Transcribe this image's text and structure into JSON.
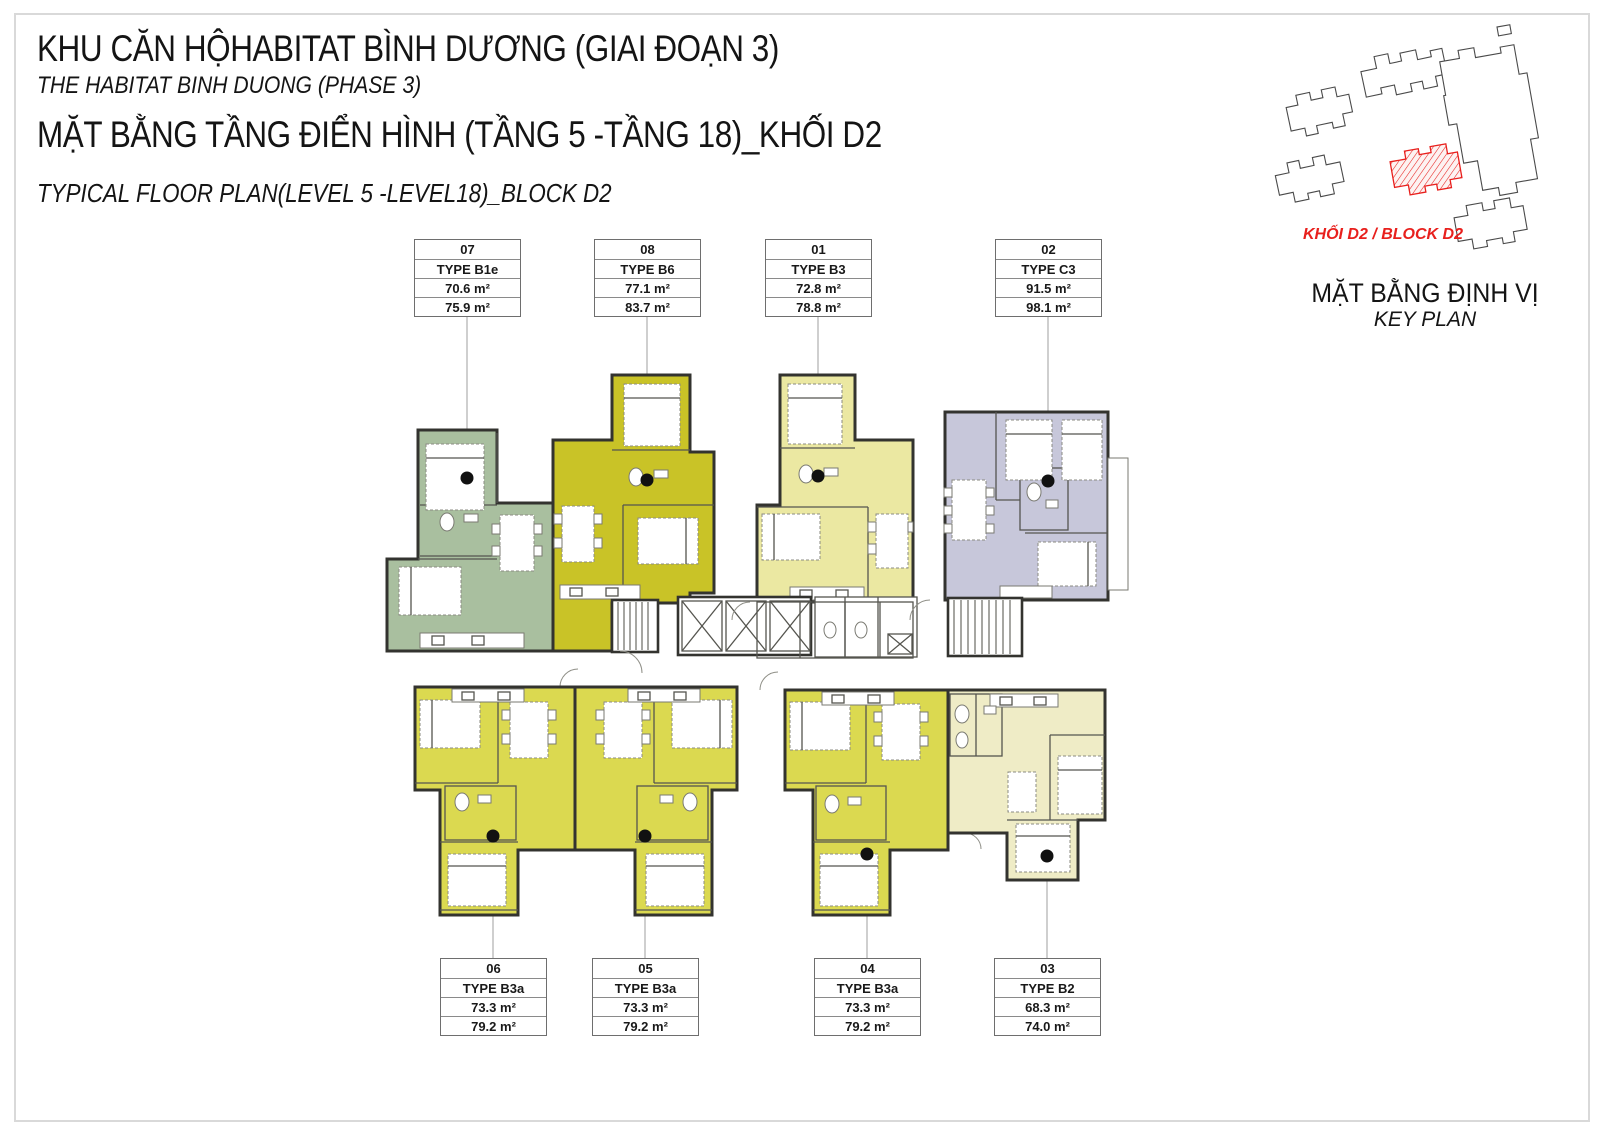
{
  "title_block": {
    "project_vi": "KHU CĂN HỘHABITAT BÌNH DƯƠNG (GIAI ĐOẠN 3)",
    "project_en": "THE HABITAT BINH DUONG (PHASE 3)",
    "plan_vi": "MẶT BẰNG TẦNG ĐIỂN HÌNH (TẦNG 5 -TẦNG 18)_KHỐI D2",
    "plan_en": "TYPICAL FLOOR PLAN(LEVEL 5 -LEVEL18)_BLOCK D2"
  },
  "key_plan": {
    "block_label": "KHỐI D2 / BLOCK D2",
    "block_label_color": "#e8201d",
    "title_vi": "MẶT BẰNG ĐỊNH VỊ",
    "title_en": "KEY PLAN"
  },
  "units": [
    {
      "number": "07",
      "type": "TYPE B1e",
      "area_net": "70.6 m²",
      "area_gross": "75.9 m²",
      "color": "#a9bf9f"
    },
    {
      "number": "08",
      "type": "TYPE B6",
      "area_net": "77.1 m²",
      "area_gross": "83.7 m²",
      "color": "#c9c327"
    },
    {
      "number": "01",
      "type": "TYPE B3",
      "area_net": "72.8 m²",
      "area_gross": "78.8 m²",
      "color": "#ebe8a2"
    },
    {
      "number": "02",
      "type": "TYPE C3",
      "area_net": "91.5 m²",
      "area_gross": "98.1 m²",
      "color": "#c7c7da"
    },
    {
      "number": "06",
      "type": "TYPE B3a",
      "area_net": "73.3 m²",
      "area_gross": "79.2 m²",
      "color": "#dbd950"
    },
    {
      "number": "05",
      "type": "TYPE B3a",
      "area_net": "73.3 m²",
      "area_gross": "79.2 m²",
      "color": "#dbd950"
    },
    {
      "number": "04",
      "type": "TYPE B3a",
      "area_net": "73.3 m²",
      "area_gross": "79.2 m²",
      "color": "#dbd950"
    },
    {
      "number": "03",
      "type": "TYPE B2",
      "area_net": "68.3 m²",
      "area_gross": "74.0 m²",
      "color": "#efecc6"
    }
  ]
}
